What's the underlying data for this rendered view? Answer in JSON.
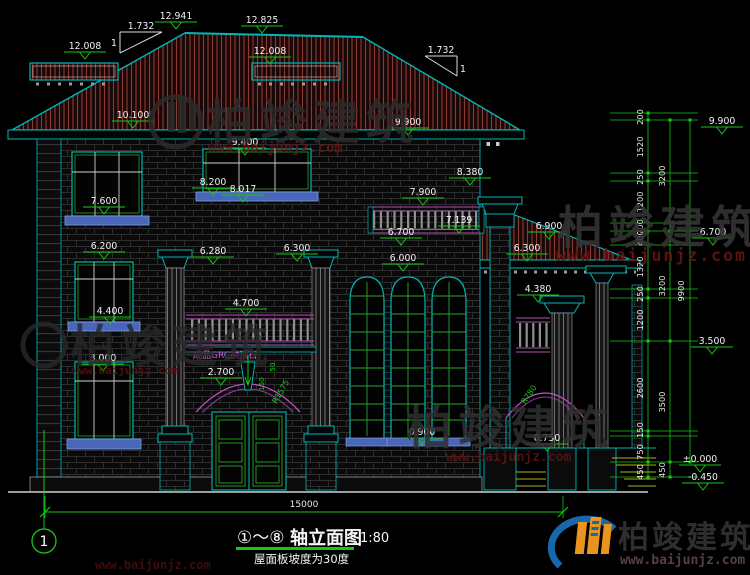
{
  "drawing": {
    "title": {
      "axes": "①～⑧",
      "name": "轴立面图",
      "scale": "1:80",
      "note": "屋面板坡度为30度",
      "axis_no": "1"
    },
    "levels": {
      "l12941": "12.941",
      "l12825": "12.825",
      "l12008": "12.008",
      "l10100": "10.100",
      "l9900": "9.900",
      "l9400": "9.400",
      "l8380": "8.380",
      "l8200": "8.200",
      "l8017": "8.017",
      "l7900": "7.900",
      "l7600": "7.600",
      "l7139": "7.139",
      "l6900": "6.900",
      "l6700": "6.700",
      "l6300": "6.300",
      "l6280": "6.280",
      "l6200": "6.200",
      "l6000": "6.000",
      "l4700": "4.700",
      "l4400": "4.400",
      "l4380": "4.380",
      "l3500": "3.500",
      "l3000": "3.000",
      "l2700": "2.700",
      "l0900": "0.900",
      "l0750": "0.750",
      "l0000": "±0.000",
      "lm0450": "-0.450"
    },
    "slope": {
      "run": "1.732",
      "rise": "1"
    },
    "notes": {
      "keystone": "成品GRC拱顶石",
      "radius_main": "R1575",
      "radius_porch": "R780",
      "dim150": "150",
      "dim50": "50"
    },
    "dims": {
      "total_width": "15000",
      "total_height": "9900",
      "chain_small": [
        "200",
        "1520",
        "250",
        "1200",
        "200",
        "400",
        "1320",
        "250",
        "1200",
        "2600",
        "150",
        "750",
        "450"
      ],
      "chain_floors": [
        "3200",
        "3200",
        "3500",
        "450"
      ]
    },
    "watermark": {
      "brand": "柏竣建筑",
      "url": "www.baijunjz.com"
    },
    "colors": {
      "background": "#000000",
      "line_teal": "#00b6b6",
      "dim_green": "#15c815",
      "text_white": "#f0f0f0",
      "roof_hatch_red": "#8a3b34",
      "accent_magenta": "#b050b0",
      "sill_blue": "#4a66b8",
      "step_yellow": "#b0b020",
      "logo_blue": "#1767ad",
      "logo_orange": "#e8941f",
      "watermark_red": "#6e1616"
    }
  }
}
